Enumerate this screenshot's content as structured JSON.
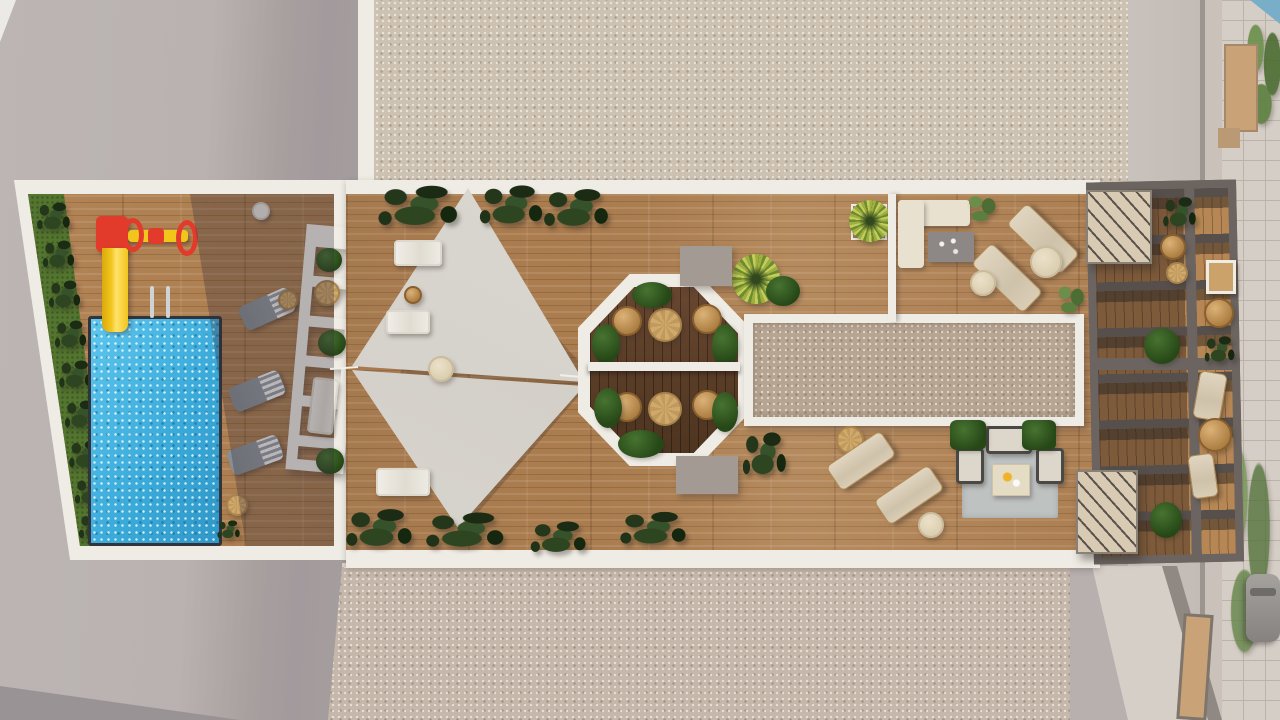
{
  "scene": {
    "type": "aerial-architectural-render",
    "description": "Top-down 3D rendering of a residential rooftop amenity terrace",
    "areas": [
      {
        "name": "pool-garden",
        "features": [
          "swimming-pool",
          "kids-slide",
          "play-spinner",
          "hedge-row",
          "sun-loungers",
          "white-slat-pergola"
        ]
      },
      {
        "name": "sun-deck",
        "features": [
          "shade-sails",
          "white-loungers",
          "tropical-planters"
        ]
      },
      {
        "name": "dining-pavilion",
        "features": [
          "octagonal-pergola",
          "round-tables",
          "wicker-chairs",
          "bushes"
        ]
      },
      {
        "name": "skylight-gravel-strip",
        "features": [
          "white-frame",
          "gravel-fill"
        ]
      },
      {
        "name": "lounge-north",
        "features": [
          "l-shaped-sofa",
          "coffee-table",
          "beige-loungers",
          "side-tables"
        ]
      },
      {
        "name": "lounge-south",
        "features": [
          "loungers",
          "outdoor-rug",
          "armchairs",
          "fire-table",
          "planter-boxes"
        ]
      },
      {
        "name": "pergola-terrace",
        "features": [
          "slatted-beams",
          "stair-canopies",
          "wicker-seating"
        ]
      },
      {
        "name": "street-side",
        "features": [
          "pavers",
          "trees",
          "parked-car",
          "walkway"
        ]
      }
    ],
    "palette": {
      "concrete": "#b7b0af",
      "concrete_shadow": "#a29a9c",
      "gravel_light": "#cdc2b2",
      "gravel_warm": "#c6b7ab",
      "gravel_inner": "#b7a491",
      "white_wall": "#efece5",
      "wood": "#ad7c4e",
      "wood_dark": "#5d3f27",
      "pool": "#41b4e2",
      "pool_rim": "#32333b",
      "grass": "#53752f",
      "plant_dark": "#22361a",
      "plant_palm": "#9fae3e",
      "plant_soft": "#5b7f3e",
      "sail": "#d9d5cf",
      "sofa_cream": "#e8e1cf",
      "table_gray": "#8d8885",
      "lounger_gray": "#8e949a",
      "lounger_beige": "#d6cab4",
      "wicker": "#c69d63",
      "rug": "#bec2c1",
      "frame_dark": "#4a4946",
      "pergola_frame": "#6b6460",
      "canopy": "#d8cab3",
      "slide_red": "#e23b2c",
      "slide_yellow": "#f2c51c",
      "paver": "#d5cec6",
      "tan_wall": "#c9a377",
      "tree_soft": "#95a683",
      "path": "#d6cfc7",
      "car": "#97948f",
      "sky_blue": "#79aec8"
    }
  }
}
